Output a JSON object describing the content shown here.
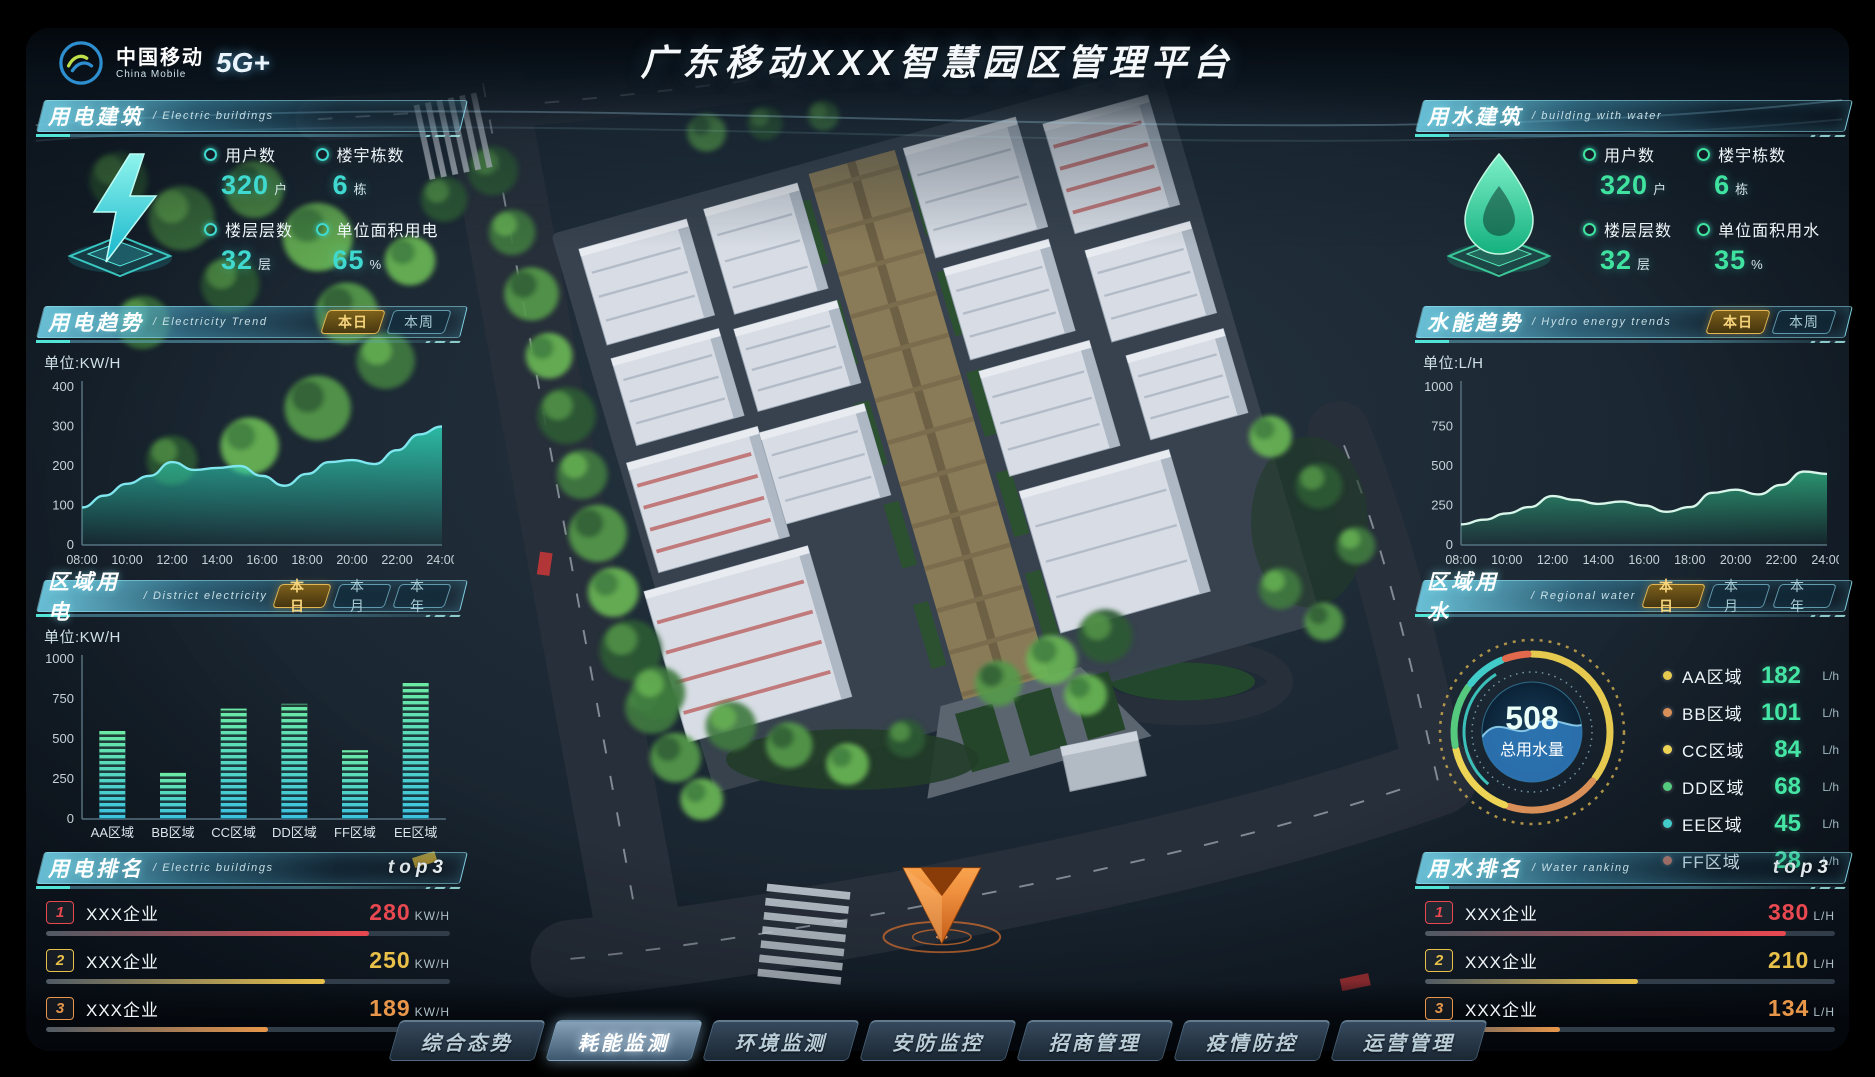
{
  "header": {
    "logo_cn": "中国移动",
    "logo_en": "China Mobile",
    "logo_badge": "5G+",
    "title": "广东移动XXX智慧园区管理平台"
  },
  "colors": {
    "accent_cyan": "#3fd9d0",
    "accent_green": "#3fe39f",
    "tab_gold": "#e2b652",
    "rank1": "#e84850",
    "rank2": "#e8c04a",
    "rank3": "#e8964a"
  },
  "panels": {
    "electric_building": {
      "title_cn": "用电建筑",
      "title_en": "/ Electric buildings",
      "icon": "lightning-icon",
      "stats": [
        {
          "label": "用户数",
          "value": "320",
          "unit": "户"
        },
        {
          "label": "楼宇栋数",
          "value": "6",
          "unit": "栋"
        },
        {
          "label": "楼层层数",
          "value": "32",
          "unit": "层"
        },
        {
          "label": "单位面积用电",
          "value": "65",
          "unit": "%"
        }
      ]
    },
    "electricity_trend": {
      "title_cn": "用电趋势",
      "title_en": "/ Electricity Trend",
      "tabs": [
        {
          "label": "本日",
          "active": true
        },
        {
          "label": "本周",
          "active": false
        }
      ],
      "unit_label": "单位:KW/H"
    },
    "district_electricity": {
      "title_cn": "区域用电",
      "title_en": "/ District electricity",
      "tabs": [
        {
          "label": "本日",
          "active": true
        },
        {
          "label": "本月",
          "active": false
        },
        {
          "label": "本年",
          "active": false
        }
      ],
      "unit_label": "单位:KW/H"
    },
    "electric_ranking": {
      "title_cn": "用电排名",
      "title_en": "/ Electric buildings",
      "badge": "top3",
      "rows": [
        {
          "rank": "1",
          "name": "XXX企业",
          "value": "280",
          "unit": "KW/H",
          "color": "#e84850",
          "pct": 80
        },
        {
          "rank": "2",
          "name": "XXX企业",
          "value": "250",
          "unit": "KW/H",
          "color": "#e8c04a",
          "pct": 69
        },
        {
          "rank": "3",
          "name": "XXX企业",
          "value": "189",
          "unit": "KW/H",
          "color": "#e8964a",
          "pct": 55
        }
      ]
    },
    "water_building": {
      "title_cn": "用水建筑",
      "title_en": "/ building with water",
      "icon": "water-drop-icon",
      "stats": [
        {
          "label": "用户数",
          "value": "320",
          "unit": "户"
        },
        {
          "label": "楼宇栋数",
          "value": "6",
          "unit": "栋"
        },
        {
          "label": "楼层层数",
          "value": "32",
          "unit": "层"
        },
        {
          "label": "单位面积用水",
          "value": "35",
          "unit": "%"
        }
      ]
    },
    "hydro_trend": {
      "title_cn": "水能趋势",
      "title_en": "/ Hydro energy trends",
      "tabs": [
        {
          "label": "本日",
          "active": true
        },
        {
          "label": "本周",
          "active": false
        }
      ],
      "unit_label": "单位:L/H"
    },
    "regional_water": {
      "title_cn": "区域用水",
      "title_en": "/ Regional water",
      "tabs": [
        {
          "label": "本日",
          "active": true
        },
        {
          "label": "本月",
          "active": false
        },
        {
          "label": "本年",
          "active": false
        }
      ]
    },
    "water_ranking": {
      "title_cn": "用水排名",
      "title_en": "/ Water ranking",
      "badge": "top3",
      "rows": [
        {
          "rank": "1",
          "name": "XXX企业",
          "value": "380",
          "unit": "L/H",
          "color": "#e84850",
          "pct": 88
        },
        {
          "rank": "2",
          "name": "XXX企业",
          "value": "210",
          "unit": "L/H",
          "color": "#e8c04a",
          "pct": 52
        },
        {
          "rank": "3",
          "name": "XXX企业",
          "value": "134",
          "unit": "L/H",
          "color": "#e8964a",
          "pct": 33
        }
      ]
    }
  },
  "nav": {
    "items": [
      {
        "label": "综合态势",
        "active": false
      },
      {
        "label": "耗能监测",
        "active": true
      },
      {
        "label": "环境监测",
        "active": false
      },
      {
        "label": "安防监控",
        "active": false
      },
      {
        "label": "招商管理",
        "active": false
      },
      {
        "label": "疫情防控",
        "active": false
      },
      {
        "label": "运营管理",
        "active": false
      }
    ]
  },
  "chart_data": [
    {
      "id": "electricity-trend",
      "type": "area",
      "title": "用电趋势(本日)",
      "ylabel": "单位:KW/H",
      "x": [
        "08:00",
        "10:00",
        "12:00",
        "14:00",
        "16:00",
        "18:00",
        "20:00",
        "22:00",
        "24:00"
      ],
      "values": [
        95,
        125,
        155,
        175,
        210,
        190,
        195,
        200,
        175,
        150,
        180,
        210,
        215,
        205,
        240,
        280,
        300
      ],
      "ylim": [
        0,
        400
      ],
      "yticks": [
        0,
        100,
        200,
        300,
        400
      ],
      "line_color": "#7fe6ee",
      "fill_color": "#2ed3b7"
    },
    {
      "id": "hydro-trend",
      "type": "area",
      "title": "水能趋势(本日)",
      "ylabel": "单位:L/H",
      "x": [
        "08:00",
        "10:00",
        "12:00",
        "14:00",
        "16:00",
        "18:00",
        "20:00",
        "22:00",
        "24:00"
      ],
      "values": [
        130,
        160,
        200,
        240,
        310,
        285,
        260,
        275,
        250,
        210,
        240,
        330,
        350,
        320,
        380,
        465,
        450
      ],
      "ylim": [
        0,
        1000
      ],
      "yticks": [
        0,
        250,
        500,
        750,
        1000
      ],
      "line_color": "#d8f5ea",
      "fill_color": "#2ea87c"
    },
    {
      "id": "district-electricity",
      "type": "bar",
      "title": "区域用电(本日)",
      "ylabel": "单位:KW/H",
      "categories": [
        "AA区域",
        "BB区域",
        "CC区域",
        "DD区域",
        "FF区域",
        "EE区域"
      ],
      "values": [
        550,
        290,
        690,
        720,
        430,
        850
      ],
      "ylim": [
        0,
        1000
      ],
      "yticks": [
        0,
        250,
        500,
        750,
        1000
      ],
      "bar_bottom_color": "#3cc2e0",
      "bar_top_color": "#6ceaa4"
    },
    {
      "id": "regional-water",
      "type": "donut",
      "title": "区域用水(本日)",
      "total": "508",
      "total_label": "总用水量",
      "unit": "L/h",
      "slices": [
        {
          "name": "AA区域",
          "value": 182,
          "color": "#e6c94f"
        },
        {
          "name": "BB区域",
          "value": 101,
          "color": "#d98f58"
        },
        {
          "name": "CC区域",
          "value": 84,
          "color": "#eed455"
        },
        {
          "name": "DD区域",
          "value": 68,
          "color": "#55c97d"
        },
        {
          "name": "EE区域",
          "value": 45,
          "color": "#41ccc9"
        },
        {
          "name": "FF区域",
          "value": 28,
          "color": "#e2694b"
        }
      ]
    }
  ]
}
